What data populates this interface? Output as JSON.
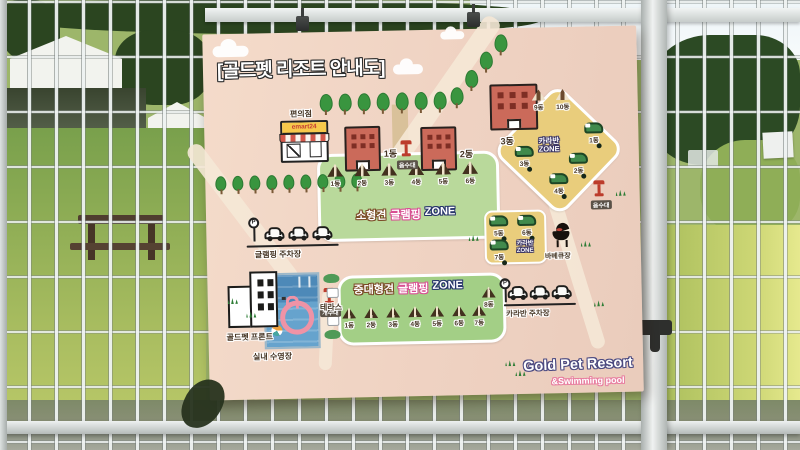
{
  "board": {
    "title": "[골드펫 리조트 안내도]",
    "store": {
      "label": "편의점",
      "sign": "emart24"
    },
    "buildings": {
      "b1": "1동",
      "b2": "2동",
      "b3": "3동"
    },
    "fountain_labels": {
      "f1": "음수대",
      "f2": "개수대",
      "f3": "음수대"
    },
    "small_dog_zone": {
      "name": "소형견",
      "activity": "글램핑",
      "zone_word": "ZONE",
      "tents": [
        "1동",
        "2동",
        "3동",
        "4동",
        "5동",
        "6동"
      ]
    },
    "large_dog_zone": {
      "name": "중대형견",
      "activity": "글램핑",
      "zone_word": "ZONE",
      "tents": [
        "1동",
        "2동",
        "3동",
        "4동",
        "5동",
        "6동",
        "7동",
        "8동"
      ]
    },
    "caravan_zone": {
      "line1": "카라반",
      "line2": "ZONE",
      "tents": [
        "9동",
        "10동"
      ],
      "caravans": [
        "1동",
        "2동",
        "3동",
        "4동"
      ]
    },
    "caravan_box": {
      "line1": "카라반",
      "line2": "ZONE",
      "caravans": [
        "5동",
        "6동",
        "7동"
      ]
    },
    "bbq_label": "바베큐장",
    "glamping_parking": {
      "p": "P",
      "label": "글램핑 주차장"
    },
    "caravan_parking": {
      "p": "P",
      "label": "카라반 주차장"
    },
    "front_label": "골드펫 프론트",
    "pool_label": "실내 수영장",
    "terrace_label": "테라스",
    "brand": {
      "line1": "Gold Pet Resort",
      "line2": "&Swimming pool"
    }
  },
  "colors": {
    "board_bg": "#f2d8c8",
    "zone_green": "#a8d08a",
    "zone_yellow": "#e9cd7c",
    "outline_brown": "#7a4a26",
    "outline_pink": "#d94f93",
    "outline_navy": "#27356b"
  }
}
